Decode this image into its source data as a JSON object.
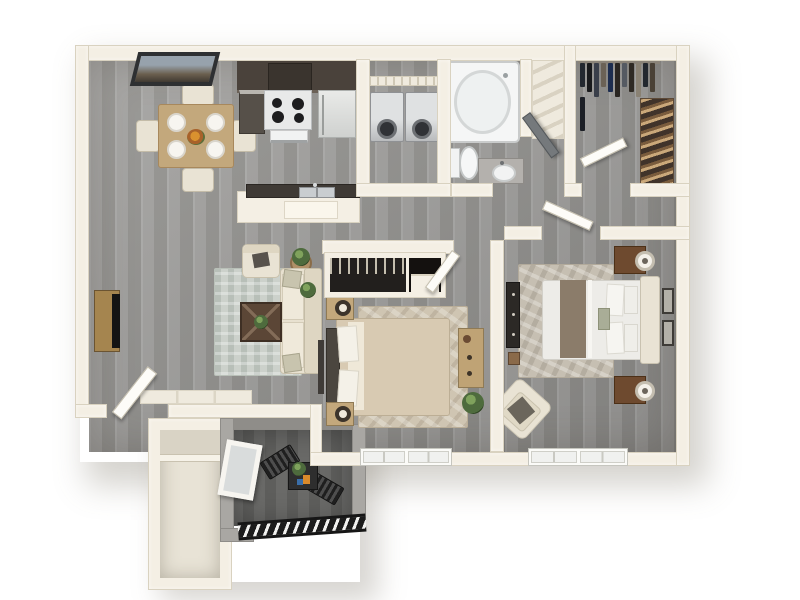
{
  "scene": {
    "description": "3D top-down rendering of a two-bedroom, one-bath apartment floor plan with lower-left patio and exterior storage closet",
    "background_color": "#ffffff"
  },
  "palette": {
    "wall": "#f4efe4",
    "wall_edge": "#d9d2c0",
    "floor_plank_a": "#a2a19f",
    "floor_plank_b": "#93928f",
    "patio_floor": "#646463",
    "patio_wall": "#a9a7a3",
    "cabinet_dark": "#4a423b",
    "counter_dark": "#3f3a35",
    "appliance_steel": "#c6c8ca",
    "fixture_white": "#f5f6f6",
    "wood_light": "#c3a87c",
    "wood_mid": "#a5854f",
    "wood_dark_brown": "#6e4a2f",
    "fabric_cream": "#e9e3d4",
    "bedding_beige": "#d8cab2",
    "bedding_white": "#edece8",
    "runner_brown": "#8b7c6a",
    "rug_living": "#ccd1cb",
    "rug_bedroom1": "#cfc5b2",
    "rug_bedroom2": "#c6bfb2",
    "plant_green": "#4e6b3d",
    "tv_black": "#141414",
    "railing_black": "#1c1c1c"
  },
  "rooms": [
    {
      "id": "dining-area",
      "label": "Dining Area"
    },
    {
      "id": "kitchen",
      "label": "Kitchen"
    },
    {
      "id": "living-room",
      "label": "Living Room"
    },
    {
      "id": "laundry-closet",
      "label": "Laundry Closet"
    },
    {
      "id": "bathroom",
      "label": "Bathroom"
    },
    {
      "id": "linen-closet",
      "label": "Linen Closet"
    },
    {
      "id": "walk-in-closet",
      "label": "Walk-in Closet"
    },
    {
      "id": "bedroom-1",
      "label": "Bedroom 1"
    },
    {
      "id": "bedroom-2",
      "label": "Bedroom 2"
    },
    {
      "id": "hallway",
      "label": "Hallway"
    },
    {
      "id": "entry",
      "label": "Entry"
    },
    {
      "id": "patio",
      "label": "Patio"
    },
    {
      "id": "storage",
      "label": "Storage Closet"
    }
  ],
  "furniture": {
    "dining_area": [
      "square dining table",
      "four cream chairs",
      "four place settings",
      "flower centerpiece",
      "wall window with view"
    ],
    "kitchen": [
      "dark upper cabinets",
      "range with four burners",
      "refrigerator",
      "dark base cabinet",
      "peninsula counter",
      "stainless double sink"
    ],
    "living_room": [
      "media console with TV",
      "cream sofa with pillows",
      "accent armchair",
      "round side table with plant",
      "dark square coffee table",
      "patterned area rug",
      "floor plant"
    ],
    "laundry_closet": [
      "washer",
      "dryer",
      "wire shelf"
    ],
    "bathroom": [
      "bathtub",
      "toilet",
      "vanity with sink",
      "open door"
    ],
    "linen_closet": [
      "angled shelves"
    ],
    "walk_in_closet": [
      "hanging garments on rod",
      "shoe rack shelves",
      "open door"
    ],
    "bedroom_1": [
      "bed with beige comforter",
      "dark headboard",
      "two wood nightstands with lamps",
      "reach-in closet with clothes",
      "shelf niche",
      "dresser with decor",
      "floor plant",
      "area rug",
      "double window",
      "open door"
    ],
    "bedroom_2": [
      "bed with white bedding and brown runner",
      "upholstered headboard",
      "two dark nightstands with round lamps",
      "two framed wall pictures",
      "dark dresser",
      "wood stool",
      "corner armchair",
      "area rug",
      "double window",
      "open door"
    ],
    "entry": [
      "open front door",
      "tile landing"
    ],
    "patio": [
      "two black slatted chairs",
      "black side table with plant",
      "leaning white frame",
      "black railing with slats"
    ],
    "storage": [
      "upper shelf compartment"
    ]
  },
  "walk_in_closet": {
    "garments": [
      "#23282f",
      "#191a1c",
      "#3a3f4a",
      "#6b6256",
      "#1d2d4f",
      "#2a2622",
      "#555a62",
      "#2f2a24",
      "#8a8274",
      "#23282f",
      "#4a4136",
      "#1c1f26"
    ],
    "shoe_shelves": 7
  },
  "counts": {
    "bedrooms": 2,
    "bathrooms": 1,
    "patio_chairs": 2,
    "dining_chairs": 4
  }
}
